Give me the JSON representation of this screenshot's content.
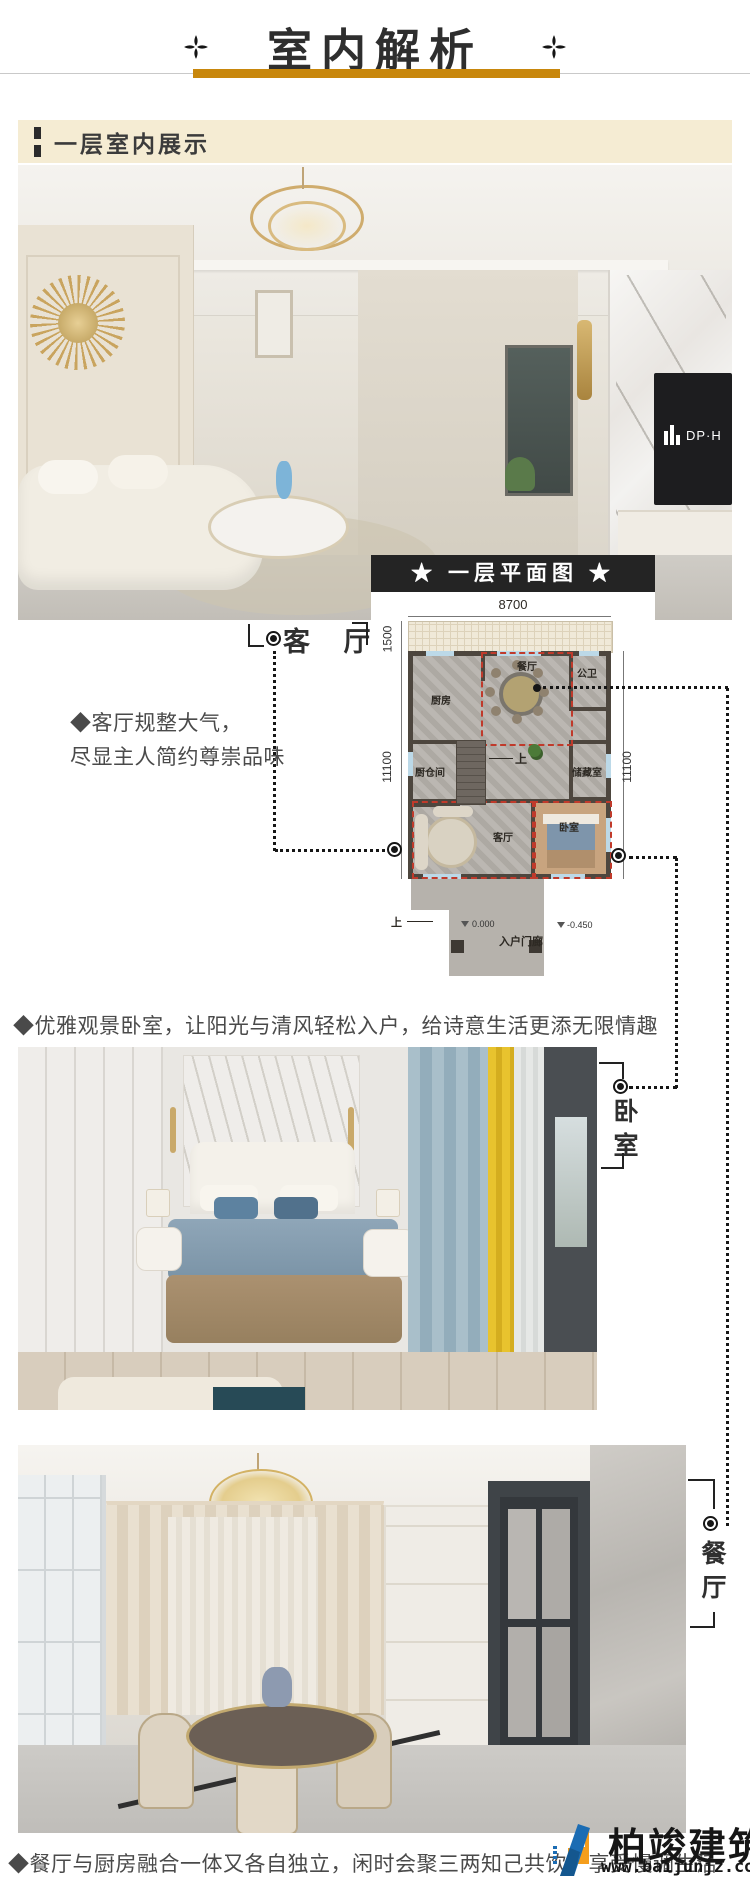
{
  "header": {
    "title": "室内解析"
  },
  "banner": {
    "label": "一层室内展示"
  },
  "living_photo": {
    "tv_logo": "DP·H"
  },
  "plan": {
    "title": "★ 一层平面图 ★",
    "dim_top": "8700",
    "dim_porch": "1500",
    "dim_left": "11100",
    "dim_right": "11100",
    "room_kitchen": "厨房",
    "room_dining": "餐厅",
    "room_bath": "公卫",
    "room_pantry": "厨仓间",
    "room_storage": "储藏室",
    "room_living": "客厅",
    "room_bedroom": "卧室",
    "stairs_up": "上",
    "stairs_up_entry": "上",
    "level_main": "0.000",
    "level_porch": "-0.450",
    "entry_porch": "入户门廊"
  },
  "living_callout": {
    "label": "客 厅",
    "desc1": "◆客厅规整大气，",
    "desc2": "尽显主人简约尊崇品味"
  },
  "bedroom_section": {
    "heading": "◆优雅观景卧室，让阳光与清风轻松入户，给诗意生活更添无限情趣",
    "label": "卧室"
  },
  "dining_section": {
    "label": "餐厅",
    "caption": "◆餐厅与厨房融合一体又各自独立，闲时会聚三两知己共饮，享受慢调生活"
  },
  "watermark": {
    "brand": "柏竣建筑",
    "url": "www.baijunjz.com"
  },
  "colors": {
    "gold": "#c8870c",
    "banner_bg": "#f5ecd3",
    "bar_dark": "#242424",
    "dash_red": "#c03a2b",
    "logo_blue": "#1b6cb3",
    "logo_orange": "#f59e1d"
  }
}
